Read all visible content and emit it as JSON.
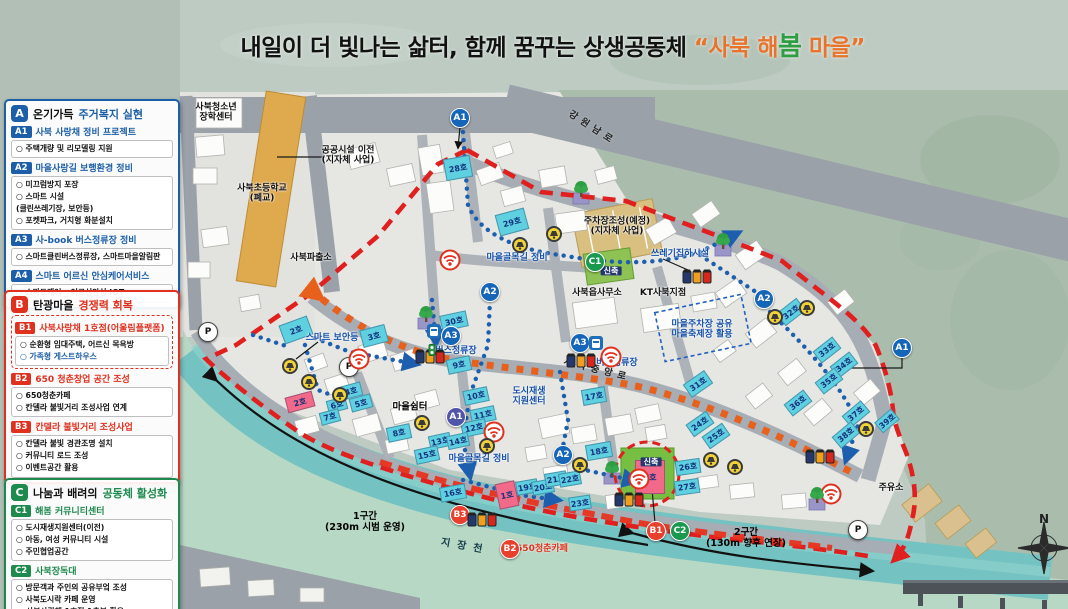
{
  "title": {
    "black": "내일이 더 빛나는 삶터,  함께 꿈꾸는 상생공동체 ",
    "q1": "“",
    "orange1": "사북 해",
    "green": "봄",
    "orange2": " 마을",
    "q2": "”",
    "accent_orange": "#e8742c",
    "accent_green": "#2f9e43"
  },
  "legend": {
    "sections": [
      {
        "letter": "A",
        "accent": "#1c5fa8",
        "title_plain": "온기가득 ",
        "title_accent": "주거복지 실현",
        "blocks": [
          {
            "badge": "A1",
            "heading": "사북 사랑채 정비 프로젝트",
            "lines": [
              {
                "t": "○ 주택개량 및 리모델링 지원"
              }
            ]
          },
          {
            "badge": "A2",
            "heading": "마을사랑길 보행환경 정비",
            "lines": [
              {
                "t": "○ 미끄럼방지 포장"
              },
              {
                "t": "○ 스마트 시설"
              },
              {
                "t": "   (클린쓰레기장, 보안등)"
              },
              {
                "t": "○ 포켓파크, 거치형 화분설치"
              }
            ]
          },
          {
            "badge": "A3",
            "heading": "사-book 버스정류장 정비",
            "lines": [
              {
                "t": "○ 스마트클린버스정류장, 스마트마을알림판"
              }
            ]
          },
          {
            "badge": "A4",
            "heading": "스마트 어르신 안심케어서비스",
            "lines": [
              {
                "t": "○ 스마트케어 _ 어르신안심 IOT"
              }
            ]
          }
        ]
      },
      {
        "letter": "B",
        "accent": "#e0301e",
        "title_plain": "탄광마을 ",
        "title_accent": "경쟁력 회복",
        "blocks": [
          {
            "badge": "B1",
            "heading": "사북사랑채 1호점(어울림플랫폼)",
            "dashed": true,
            "lines": [
              {
                "t": "○ 순환형 임대주택, 어르신 목욕방"
              },
              {
                "t": "○ 가족형 게스트하우스",
                "color": "#1c5fa8"
              }
            ]
          },
          {
            "badge": "B2",
            "heading": "650 청춘창업 공간 조성",
            "lines": [
              {
                "t": "○ 650청춘카페"
              },
              {
                "t": "○ 칸델라 불빛거리 조성사업 연계"
              }
            ]
          },
          {
            "badge": "B3",
            "heading": "칸델라 불빛거리 조성사업",
            "lines": [
              {
                "t": "○ 칸델라 불빛 경관조명 설치"
              },
              {
                "t": "○ 커뮤니티 로드 조성"
              },
              {
                "t": "○ 이벤트공간 활용"
              }
            ]
          }
        ]
      },
      {
        "letter": "C",
        "accent": "#1e8a4e",
        "title_plain": "나눔과 배려의 ",
        "title_accent": "공동체 활성화",
        "blocks": [
          {
            "badge": "C1",
            "heading": "해봄 커뮤니티센터",
            "lines": [
              {
                "t": "○ 도시재생지원센터(이전)"
              },
              {
                "t": "○ 아동, 여성 커뮤니티 시설"
              },
              {
                "t": "○ 주민협업공간"
              }
            ]
          },
          {
            "badge": "C2",
            "heading": "사북장독대",
            "lines": [
              {
                "t": "○ 방문객과 주인의 공유부엌 조성"
              },
              {
                "t": "○ 사북도시락 카페 운영"
              },
              {
                "t": "■ 사북사랑채 1호점 1층부 활용"
              }
            ]
          }
        ]
      }
    ]
  },
  "map": {
    "compass_n": "N",
    "colors": {
      "building_blue": "#5ed0e0",
      "building_pink": "#f2698a",
      "boundary_red": "#e01f1f",
      "route_orange": "#e8611c",
      "path_blue": "#1d5fae",
      "river": "#74c2c2"
    },
    "labels": [
      {
        "t": "사북청소년\n장학센터",
        "x": 216,
        "y": 113,
        "s": "place"
      },
      {
        "t": "사북초등학교\n(폐교)",
        "x": 262,
        "y": 194,
        "s": "place"
      },
      {
        "t": "공공시설 이전\n(지자체 사업)",
        "x": 348,
        "y": 156,
        "s": "place"
      },
      {
        "t": "사북파출소",
        "x": 311,
        "y": 258,
        "s": "place"
      },
      {
        "t": "주차장조성(예정)\n(지자체 사업)",
        "x": 617,
        "y": 227,
        "s": "place"
      },
      {
        "t": "사북읍사무소",
        "x": 597,
        "y": 293,
        "s": "place"
      },
      {
        "t": "KT사북지점",
        "x": 663,
        "y": 293,
        "s": "place"
      },
      {
        "t": "마을쉼터",
        "x": 410,
        "y": 408,
        "s": "shelter"
      },
      {
        "t": "주유소",
        "x": 891,
        "y": 488,
        "s": "place"
      },
      {
        "t": "강원남로",
        "x": 592,
        "y": 129,
        "s": "road",
        "rot": 33
      },
      {
        "t": "사북중앙로",
        "x": 597,
        "y": 371,
        "s": "road",
        "rot": 14
      },
      {
        "t": "지장천",
        "x": 465,
        "y": 547,
        "s": "river",
        "rot": 10
      },
      {
        "t": "1구간\n(230m 시범 운영)",
        "x": 365,
        "y": 523,
        "s": "route"
      },
      {
        "t": "2구간\n(130m 향후 연장)",
        "x": 746,
        "y": 539,
        "s": "route"
      },
      {
        "t": "마을골목길 정비",
        "x": 517,
        "y": 258,
        "s": "blue"
      },
      {
        "t": "마을골목길 정비",
        "x": 479,
        "y": 459,
        "s": "blue"
      },
      {
        "t": "쓰레기집하시설",
        "x": 680,
        "y": 254,
        "s": "blue"
      },
      {
        "t": "스마트 보안등",
        "x": 332,
        "y": 338,
        "s": "blue"
      },
      {
        "t": "버스정류장",
        "x": 456,
        "y": 351,
        "s": "blue"
      },
      {
        "t": "버스정류장",
        "x": 617,
        "y": 363,
        "s": "blue"
      },
      {
        "t": "도시재생\n지원센터",
        "x": 529,
        "y": 397,
        "s": "blue"
      },
      {
        "t": "마을주차장 공유\n마을축제장 활용",
        "x": 702,
        "y": 330,
        "s": "blue"
      },
      {
        "t": "650청춘카페",
        "x": 542,
        "y": 549,
        "s": "red"
      },
      {
        "t": "신축",
        "x": 611,
        "y": 271,
        "s": "tag"
      },
      {
        "t": "신축",
        "x": 651,
        "y": 462,
        "s": "tag"
      }
    ],
    "markers": [
      {
        "t": "A1",
        "x": 460,
        "y": 118,
        "c": "a"
      },
      {
        "t": "A1",
        "x": 456,
        "y": 417,
        "c": "a2"
      },
      {
        "t": "A1",
        "x": 902,
        "y": 348,
        "c": "a"
      },
      {
        "t": "A2",
        "x": 490,
        "y": 292,
        "c": "a"
      },
      {
        "t": "A2",
        "x": 764,
        "y": 299,
        "c": "a"
      },
      {
        "t": "A2",
        "x": 563,
        "y": 455,
        "c": "a"
      },
      {
        "t": "A3",
        "x": 451,
        "y": 336,
        "c": "a"
      },
      {
        "t": "A3",
        "x": 580,
        "y": 343,
        "c": "a"
      },
      {
        "t": "B1",
        "x": 656,
        "y": 531,
        "c": "b"
      },
      {
        "t": "B2",
        "x": 510,
        "y": 549,
        "c": "b"
      },
      {
        "t": "B3",
        "x": 460,
        "y": 515,
        "c": "b"
      },
      {
        "t": "C1",
        "x": 595,
        "y": 262,
        "c": "c"
      },
      {
        "t": "C2",
        "x": 680,
        "y": 531,
        "c": "c"
      },
      {
        "t": "P",
        "x": 208,
        "y": 332,
        "c": "p"
      },
      {
        "t": "P",
        "x": 349,
        "y": 367,
        "c": "p"
      },
      {
        "t": "P",
        "x": 858,
        "y": 530,
        "c": "p"
      }
    ],
    "buildings": [
      {
        "n": "2호",
        "x": 296,
        "y": 330,
        "w": 30,
        "h": 20,
        "r": -20,
        "c": "blue"
      },
      {
        "n": "3호",
        "x": 374,
        "y": 336,
        "w": 26,
        "h": 18,
        "r": -15,
        "c": "blue"
      },
      {
        "n": "2호",
        "x": 300,
        "y": 402,
        "w": 28,
        "h": 16,
        "r": -15,
        "c": "pink"
      },
      {
        "n": "4호",
        "x": 351,
        "y": 391,
        "w": 22,
        "h": 14,
        "r": -15,
        "c": "blue"
      },
      {
        "n": "5호",
        "x": 361,
        "y": 403,
        "w": 22,
        "h": 14,
        "r": -15,
        "c": "blue"
      },
      {
        "n": "6호",
        "x": 337,
        "y": 405,
        "w": 20,
        "h": 13,
        "r": -15,
        "c": "blue"
      },
      {
        "n": "7호",
        "x": 330,
        "y": 417,
        "w": 20,
        "h": 13,
        "r": -15,
        "c": "blue"
      },
      {
        "n": "8호",
        "x": 399,
        "y": 433,
        "w": 24,
        "h": 15,
        "r": -12,
        "c": "blue"
      },
      {
        "n": "9호",
        "x": 459,
        "y": 365,
        "w": 24,
        "h": 15,
        "r": -12,
        "c": "blue"
      },
      {
        "n": "10호",
        "x": 476,
        "y": 396,
        "w": 25,
        "h": 15,
        "r": -12,
        "c": "blue"
      },
      {
        "n": "11호",
        "x": 483,
        "y": 415,
        "w": 25,
        "h": 15,
        "r": -12,
        "c": "blue"
      },
      {
        "n": "12호",
        "x": 474,
        "y": 428,
        "w": 25,
        "h": 15,
        "r": -12,
        "c": "blue"
      },
      {
        "n": "13호",
        "x": 440,
        "y": 441,
        "w": 22,
        "h": 14,
        "r": -12,
        "c": "blue"
      },
      {
        "n": "14호",
        "x": 458,
        "y": 441,
        "w": 22,
        "h": 14,
        "r": -12,
        "c": "blue"
      },
      {
        "n": "15호",
        "x": 427,
        "y": 455,
        "w": 24,
        "h": 15,
        "r": -12,
        "c": "blue"
      },
      {
        "n": "16호",
        "x": 453,
        "y": 493,
        "w": 26,
        "h": 15,
        "r": -10,
        "c": "blue"
      },
      {
        "n": "17호",
        "x": 594,
        "y": 396,
        "w": 24,
        "h": 16,
        "r": -10,
        "c": "blue"
      },
      {
        "n": "18호",
        "x": 599,
        "y": 451,
        "w": 26,
        "h": 16,
        "r": -10,
        "c": "blue"
      },
      {
        "n": "19호",
        "x": 527,
        "y": 487,
        "w": 22,
        "h": 14,
        "r": -10,
        "c": "blue"
      },
      {
        "n": "20호",
        "x": 543,
        "y": 487,
        "w": 22,
        "h": 14,
        "r": -10,
        "c": "blue"
      },
      {
        "n": "21호",
        "x": 556,
        "y": 479,
        "w": 22,
        "h": 14,
        "r": -10,
        "c": "blue"
      },
      {
        "n": "22호",
        "x": 570,
        "y": 479,
        "w": 22,
        "h": 14,
        "r": -10,
        "c": "blue"
      },
      {
        "n": "23호",
        "x": 580,
        "y": 503,
        "w": 22,
        "h": 14,
        "r": -8,
        "c": "blue"
      },
      {
        "n": "24호",
        "x": 700,
        "y": 424,
        "w": 25,
        "h": 15,
        "r": -35,
        "c": "blue"
      },
      {
        "n": "25호",
        "x": 716,
        "y": 436,
        "w": 25,
        "h": 15,
        "r": -35,
        "c": "blue"
      },
      {
        "n": "26호",
        "x": 688,
        "y": 467,
        "w": 25,
        "h": 15,
        "r": -8,
        "c": "blue"
      },
      {
        "n": "27호",
        "x": 687,
        "y": 487,
        "w": 25,
        "h": 15,
        "r": -8,
        "c": "blue"
      },
      {
        "n": "28호",
        "x": 458,
        "y": 168,
        "w": 27,
        "h": 22,
        "r": -10,
        "c": "blue"
      },
      {
        "n": "29호",
        "x": 512,
        "y": 222,
        "w": 30,
        "h": 22,
        "r": -15,
        "c": "blue"
      },
      {
        "n": "30호",
        "x": 454,
        "y": 321,
        "w": 27,
        "h": 16,
        "r": -12,
        "c": "blue"
      },
      {
        "n": "31호",
        "x": 698,
        "y": 384,
        "w": 26,
        "h": 16,
        "r": -35,
        "c": "blue"
      },
      {
        "n": "32호",
        "x": 791,
        "y": 312,
        "w": 26,
        "h": 16,
        "r": -38,
        "c": "blue"
      },
      {
        "n": "33호",
        "x": 827,
        "y": 350,
        "w": 25,
        "h": 15,
        "r": -38,
        "c": "blue"
      },
      {
        "n": "34호",
        "x": 844,
        "y": 365,
        "w": 25,
        "h": 15,
        "r": -38,
        "c": "blue"
      },
      {
        "n": "35호",
        "x": 829,
        "y": 381,
        "w": 25,
        "h": 15,
        "r": -38,
        "c": "blue"
      },
      {
        "n": "36호",
        "x": 798,
        "y": 403,
        "w": 25,
        "h": 15,
        "r": -38,
        "c": "blue"
      },
      {
        "n": "37호",
        "x": 856,
        "y": 414,
        "w": 25,
        "h": 15,
        "r": -40,
        "c": "blue"
      },
      {
        "n": "38호",
        "x": 846,
        "y": 435,
        "w": 25,
        "h": 15,
        "r": -40,
        "c": "blue"
      },
      {
        "n": "39호",
        "x": 887,
        "y": 421,
        "w": 22,
        "h": 14,
        "r": -40,
        "c": "blue"
      },
      {
        "n": "1호",
        "x": 507,
        "y": 495,
        "w": 20,
        "h": 26,
        "r": -12,
        "c": "pink"
      },
      {
        "n": "1호",
        "x": 650,
        "y": 477,
        "w": 30,
        "h": 34,
        "r": 0,
        "c": "pink"
      }
    ],
    "icons": {
      "wifi": [
        [
          450,
          260
        ],
        [
          359,
          359
        ],
        [
          611,
          357
        ],
        [
          494,
          432
        ],
        [
          639,
          479
        ],
        [
          831,
          494
        ]
      ],
      "security_light": [
        [
          520,
          245
        ],
        [
          554,
          234
        ],
        [
          290,
          366
        ],
        [
          309,
          382
        ],
        [
          340,
          395
        ],
        [
          422,
          423
        ],
        [
          487,
          446
        ],
        [
          580,
          465
        ],
        [
          775,
          317
        ],
        [
          807,
          308
        ],
        [
          711,
          460
        ],
        [
          735,
          467
        ],
        [
          866,
          429
        ]
      ],
      "tree": [
        [
          426,
          316
        ],
        [
          581,
          191
        ],
        [
          723,
          243
        ],
        [
          612,
          471
        ],
        [
          817,
          497
        ]
      ],
      "trash_bins": [
        [
          430,
          357
        ],
        [
          581,
          361
        ],
        [
          697,
          277
        ],
        [
          482,
          520
        ],
        [
          629,
          500
        ],
        [
          820,
          457
        ]
      ],
      "bus_stop": [
        [
          434,
          331
        ],
        [
          596,
          343
        ]
      ],
      "traffic_light": [
        [
          432,
          350
        ]
      ]
    }
  }
}
